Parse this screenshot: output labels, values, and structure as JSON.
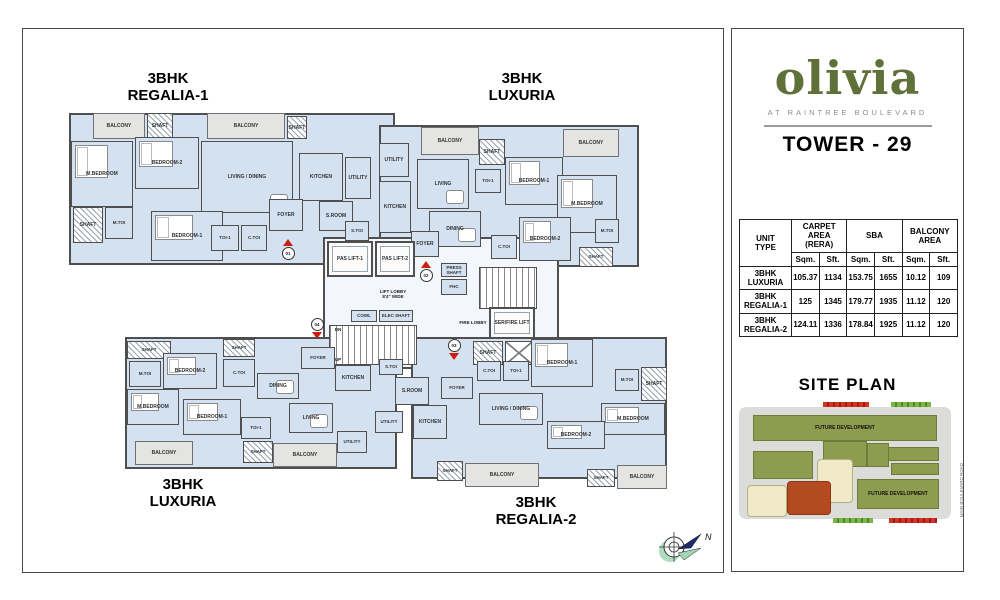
{
  "panel": {
    "logo": "olivia",
    "tagline": "AT RAINTREE BOULEVARD",
    "tower": "TOWER - 29",
    "brand_green": "#5f7038",
    "table": {
      "groups": {
        "unit": {
          "l1": "UNIT",
          "l2": "TYPE"
        },
        "carpet": {
          "l1": "CARPET AREA",
          "l2": "(RERA)"
        },
        "sba": {
          "l1": "SBA",
          "l2": ""
        },
        "balcony": {
          "l1": "BALCONY",
          "l2": "AREA"
        }
      },
      "sub_headers": [
        "Sqm.",
        "Sft.",
        "Sqm.",
        "Sft.",
        "Sqm.",
        "Sft."
      ],
      "rows": [
        {
          "type": "3BHK LUXURIA",
          "values": [
            "105.37",
            "1134",
            "153.75",
            "1655",
            "10.12",
            "109"
          ]
        },
        {
          "type": "3BHK REGALIA-1",
          "values": [
            "125",
            "1345",
            "179.77",
            "1935",
            "11.12",
            "120"
          ]
        },
        {
          "type": "3BHK REGALIA-2",
          "values": [
            "124.11",
            "1336",
            "178.84",
            "1925",
            "11.12",
            "120"
          ]
        }
      ]
    },
    "site_plan_title": "SITE PLAN",
    "site": {
      "road_label": "MAIN BOULEVARD ROAD",
      "blocks": [
        {
          "t": "green",
          "x": 14,
          "y": 18,
          "w": 184,
          "h": 26,
          "label": "FUTURE DEVELOPMENT"
        },
        {
          "t": "green",
          "x": 84,
          "y": 44,
          "w": 44,
          "h": 26
        },
        {
          "t": "green",
          "x": 14,
          "y": 54,
          "w": 60,
          "h": 28
        },
        {
          "t": "green",
          "x": 136,
          "y": 50,
          "w": 64,
          "h": 14
        },
        {
          "t": "green",
          "x": 128,
          "y": 46,
          "w": 22,
          "h": 24
        },
        {
          "t": "green",
          "x": 152,
          "y": 66,
          "w": 48,
          "h": 12
        },
        {
          "t": "green",
          "x": 118,
          "y": 82,
          "w": 82,
          "h": 30,
          "label": "FUTURE DEVELOPMENT"
        },
        {
          "t": "cream",
          "x": 8,
          "y": 88,
          "w": 40,
          "h": 32
        },
        {
          "t": "cream",
          "x": 78,
          "y": 62,
          "w": 36,
          "h": 44
        },
        {
          "t": "red",
          "x": 48,
          "y": 84,
          "w": 44,
          "h": 34
        },
        {
          "t": "mark-red",
          "x": 84,
          "y": 5,
          "w": 46,
          "h": 5
        },
        {
          "t": "mark-green",
          "x": 152,
          "y": 5,
          "w": 40,
          "h": 5
        },
        {
          "t": "mark-green",
          "x": 94,
          "y": 121,
          "w": 40,
          "h": 5
        },
        {
          "t": "mark-red",
          "x": 150,
          "y": 121,
          "w": 48,
          "h": 5
        }
      ]
    }
  },
  "compass_label": "N",
  "plan": {
    "unit_titles": [
      {
        "line1": "3BHK",
        "line2": "REGALIA-1",
        "cx": 145,
        "y": 42
      },
      {
        "line1": "3BHK",
        "line2": "LUXURIA",
        "cx": 499,
        "y": 42
      },
      {
        "line1": "3BHK",
        "line2": "LUXURIA",
        "cx": 160,
        "y": 448
      },
      {
        "line1": "3BHK",
        "line2": "REGALIA-2",
        "cx": 513,
        "y": 466
      }
    ],
    "wings": [
      {
        "x": 46,
        "y": 84,
        "w": 326,
        "h": 152,
        "core": false
      },
      {
        "x": 356,
        "y": 96,
        "w": 260,
        "h": 142,
        "core": false
      },
      {
        "x": 300,
        "y": 208,
        "w": 236,
        "h": 132,
        "core": true
      },
      {
        "x": 102,
        "y": 308,
        "w": 272,
        "h": 132,
        "core": false
      },
      {
        "x": 388,
        "y": 308,
        "w": 256,
        "h": 142,
        "core": false
      }
    ],
    "rooms": [
      {
        "n": "BALCONY",
        "x": 70,
        "y": 84,
        "w": 52,
        "h": 26,
        "t": "balcony"
      },
      {
        "n": "SHAFT",
        "x": 124,
        "y": 84,
        "w": 26,
        "h": 26,
        "t": "shaft"
      },
      {
        "n": "BALCONY",
        "x": 184,
        "y": 84,
        "w": 78,
        "h": 26,
        "t": "balcony"
      },
      {
        "n": "SHAFT",
        "x": 264,
        "y": 87,
        "w": 20,
        "h": 23,
        "t": "shaft"
      },
      {
        "n": "M.BEDROOM",
        "x": 48,
        "y": 112,
        "w": 62,
        "h": 66,
        "t": "room",
        "f": "bed"
      },
      {
        "n": "BEDROOM-2",
        "x": 112,
        "y": 108,
        "w": 64,
        "h": 52,
        "t": "room",
        "f": "bed"
      },
      {
        "n": "LIVING / DINING",
        "x": 178,
        "y": 112,
        "w": 92,
        "h": 72,
        "t": "room",
        "f": "table"
      },
      {
        "n": "KITCHEN",
        "x": 276,
        "y": 124,
        "w": 44,
        "h": 48,
        "t": "room"
      },
      {
        "n": "UTILITY",
        "x": 322,
        "y": 128,
        "w": 26,
        "h": 42,
        "t": "room"
      },
      {
        "n": "SHAFT",
        "x": 50,
        "y": 178,
        "w": 30,
        "h": 36,
        "t": "shaft"
      },
      {
        "n": "M.TOI",
        "x": 82,
        "y": 178,
        "w": 28,
        "h": 32,
        "t": "toi"
      },
      {
        "n": "BEDROOM-1",
        "x": 128,
        "y": 182,
        "w": 72,
        "h": 50,
        "t": "room",
        "f": "bed"
      },
      {
        "n": "TOI-1",
        "x": 188,
        "y": 196,
        "w": 28,
        "h": 26,
        "t": "toi"
      },
      {
        "n": "C.TOI",
        "x": 218,
        "y": 196,
        "w": 26,
        "h": 26,
        "t": "toi"
      },
      {
        "n": "FOYER",
        "x": 246,
        "y": 170,
        "w": 34,
        "h": 32,
        "t": "room"
      },
      {
        "n": "S.ROOM",
        "x": 296,
        "y": 172,
        "w": 34,
        "h": 30,
        "t": "room"
      },
      {
        "n": "S.TOI",
        "x": 322,
        "y": 192,
        "w": 24,
        "h": 20,
        "t": "toi"
      },
      {
        "n": "UTILITY",
        "x": 356,
        "y": 114,
        "w": 30,
        "h": 34,
        "t": "room"
      },
      {
        "n": "KITCHEN",
        "x": 356,
        "y": 152,
        "w": 32,
        "h": 52,
        "t": "room"
      },
      {
        "n": "BALCONY",
        "x": 398,
        "y": 98,
        "w": 58,
        "h": 28,
        "t": "balcony"
      },
      {
        "n": "LIVING",
        "x": 394,
        "y": 130,
        "w": 52,
        "h": 50,
        "t": "room",
        "f": "table"
      },
      {
        "n": "DINING",
        "x": 406,
        "y": 182,
        "w": 52,
        "h": 36,
        "t": "room",
        "f": "table"
      },
      {
        "n": "SHAFT",
        "x": 456,
        "y": 110,
        "w": 26,
        "h": 26,
        "t": "shaft"
      },
      {
        "n": "TOI-1",
        "x": 452,
        "y": 140,
        "w": 26,
        "h": 24,
        "t": "toi"
      },
      {
        "n": "BEDROOM-1",
        "x": 482,
        "y": 128,
        "w": 58,
        "h": 48,
        "t": "room",
        "f": "bed"
      },
      {
        "n": "BALCONY",
        "x": 540,
        "y": 100,
        "w": 56,
        "h": 28,
        "t": "balcony"
      },
      {
        "n": "M.BEDROOM",
        "x": 534,
        "y": 146,
        "w": 60,
        "h": 58,
        "t": "room",
        "f": "bed"
      },
      {
        "n": "BEDROOM-2",
        "x": 496,
        "y": 188,
        "w": 52,
        "h": 44,
        "t": "room",
        "f": "bed"
      },
      {
        "n": "C.TOI",
        "x": 468,
        "y": 206,
        "w": 26,
        "h": 24,
        "t": "toi"
      },
      {
        "n": "M.TOI",
        "x": 572,
        "y": 190,
        "w": 24,
        "h": 24,
        "t": "toi"
      },
      {
        "n": "SHAFT",
        "x": 556,
        "y": 218,
        "w": 34,
        "h": 20,
        "t": "shaft"
      },
      {
        "n": "FOYER",
        "x": 388,
        "y": 202,
        "w": 28,
        "h": 26,
        "t": "room"
      },
      {
        "n": "PAS LIFT-1",
        "x": 304,
        "y": 212,
        "w": 46,
        "h": 36,
        "t": "lift"
      },
      {
        "n": "PAS LIFT-2",
        "x": 352,
        "y": 212,
        "w": 40,
        "h": 36,
        "t": "lift"
      },
      {
        "n": "LIFT LOBBY\n8'4\" WIDE",
        "x": 330,
        "y": 256,
        "w": 80,
        "h": 18,
        "t": "open"
      },
      {
        "n": "COWL",
        "x": 328,
        "y": 281,
        "w": 26,
        "h": 12,
        "t": "room"
      },
      {
        "n": "ELEC SHAFT",
        "x": 356,
        "y": 281,
        "w": 34,
        "h": 12,
        "t": "room"
      },
      {
        "n": "",
        "x": 306,
        "y": 296,
        "w": 88,
        "h": 40,
        "t": "stair"
      },
      {
        "n": "DN",
        "x": 308,
        "y": 297,
        "w": 14,
        "h": 8,
        "t": "open"
      },
      {
        "n": "UP",
        "x": 308,
        "y": 327,
        "w": 14,
        "h": 8,
        "t": "open"
      },
      {
        "n": "PRESS SHAFT",
        "x": 418,
        "y": 234,
        "w": 26,
        "h": 14,
        "t": "room"
      },
      {
        "n": "FHC",
        "x": 418,
        "y": 250,
        "w": 26,
        "h": 16,
        "t": "room"
      },
      {
        "n": "",
        "x": 456,
        "y": 238,
        "w": 58,
        "h": 42,
        "t": "stair"
      },
      {
        "n": "FIRE LOBBY",
        "x": 424,
        "y": 288,
        "w": 52,
        "h": 12,
        "t": "open"
      },
      {
        "n": "SER/FIRE LIFT",
        "x": 466,
        "y": 278,
        "w": 46,
        "h": 32,
        "t": "lift"
      },
      {
        "n": "SHAFT",
        "x": 450,
        "y": 312,
        "w": 30,
        "h": 24,
        "t": "shaft"
      },
      {
        "n": "",
        "x": 482,
        "y": 312,
        "w": 28,
        "h": 24,
        "t": "xbox"
      },
      {
        "n": "SHAFT",
        "x": 104,
        "y": 312,
        "w": 44,
        "h": 18,
        "t": "shaft"
      },
      {
        "n": "M.TOI",
        "x": 106,
        "y": 332,
        "w": 32,
        "h": 26,
        "t": "toi"
      },
      {
        "n": "BEDROOM-2",
        "x": 140,
        "y": 324,
        "w": 54,
        "h": 36,
        "t": "room",
        "f": "bed"
      },
      {
        "n": "SHAFT",
        "x": 200,
        "y": 310,
        "w": 32,
        "h": 18,
        "t": "shaft"
      },
      {
        "n": "C.TOI",
        "x": 200,
        "y": 330,
        "w": 32,
        "h": 28,
        "t": "toi"
      },
      {
        "n": "FOYER",
        "x": 278,
        "y": 318,
        "w": 34,
        "h": 22,
        "t": "room"
      },
      {
        "n": "DINING",
        "x": 234,
        "y": 344,
        "w": 42,
        "h": 26,
        "t": "room",
        "f": "table"
      },
      {
        "n": "KITCHEN",
        "x": 312,
        "y": 336,
        "w": 36,
        "h": 26,
        "t": "room"
      },
      {
        "n": "S.TOI",
        "x": 356,
        "y": 330,
        "w": 24,
        "h": 16,
        "t": "toi"
      },
      {
        "n": "S.ROOM",
        "x": 372,
        "y": 348,
        "w": 34,
        "h": 28,
        "t": "room"
      },
      {
        "n": "M.BEDROOM",
        "x": 104,
        "y": 360,
        "w": 52,
        "h": 36,
        "t": "room",
        "f": "bed"
      },
      {
        "n": "BEDROOM-1",
        "x": 160,
        "y": 370,
        "w": 58,
        "h": 36,
        "t": "room",
        "f": "bed"
      },
      {
        "n": "TOI-1",
        "x": 218,
        "y": 388,
        "w": 30,
        "h": 22,
        "t": "toi"
      },
      {
        "n": "LIVING",
        "x": 266,
        "y": 374,
        "w": 44,
        "h": 30,
        "t": "room",
        "f": "table"
      },
      {
        "n": "UTILITY",
        "x": 352,
        "y": 382,
        "w": 28,
        "h": 22,
        "t": "room"
      },
      {
        "n": "UTILITY",
        "x": 314,
        "y": 402,
        "w": 30,
        "h": 22,
        "t": "room"
      },
      {
        "n": "BALCONY",
        "x": 112,
        "y": 412,
        "w": 58,
        "h": 24,
        "t": "balcony"
      },
      {
        "n": "SHAFT",
        "x": 220,
        "y": 412,
        "w": 30,
        "h": 22,
        "t": "shaft"
      },
      {
        "n": "BALCONY",
        "x": 250,
        "y": 414,
        "w": 64,
        "h": 24,
        "t": "balcony"
      },
      {
        "n": "FOYER",
        "x": 418,
        "y": 348,
        "w": 32,
        "h": 22,
        "t": "room"
      },
      {
        "n": "C.TOI",
        "x": 454,
        "y": 332,
        "w": 24,
        "h": 20,
        "t": "toi"
      },
      {
        "n": "TOI-1",
        "x": 480,
        "y": 332,
        "w": 26,
        "h": 20,
        "t": "toi"
      },
      {
        "n": "BEDROOM-1",
        "x": 508,
        "y": 310,
        "w": 62,
        "h": 48,
        "t": "room",
        "f": "bed"
      },
      {
        "n": "M.TOI",
        "x": 592,
        "y": 340,
        "w": 24,
        "h": 22,
        "t": "toi"
      },
      {
        "n": "SHAFT",
        "x": 618,
        "y": 338,
        "w": 26,
        "h": 34,
        "t": "shaft"
      },
      {
        "n": "LIVING / DINING",
        "x": 456,
        "y": 364,
        "w": 64,
        "h": 32,
        "t": "room",
        "f": "table"
      },
      {
        "n": "KITCHEN",
        "x": 390,
        "y": 376,
        "w": 34,
        "h": 34,
        "t": "room"
      },
      {
        "n": "M.BEDROOM",
        "x": 578,
        "y": 374,
        "w": 64,
        "h": 32,
        "t": "room",
        "f": "bed"
      },
      {
        "n": "BEDROOM-2",
        "x": 524,
        "y": 392,
        "w": 58,
        "h": 28,
        "t": "room",
        "f": "bed"
      },
      {
        "n": "SHAFT",
        "x": 414,
        "y": 432,
        "w": 26,
        "h": 20,
        "t": "shaft"
      },
      {
        "n": "BALCONY",
        "x": 442,
        "y": 434,
        "w": 74,
        "h": 24,
        "t": "balcony"
      },
      {
        "n": "SHAFT",
        "x": 564,
        "y": 440,
        "w": 28,
        "h": 18,
        "t": "shaft"
      },
      {
        "n": "BALCONY",
        "x": 594,
        "y": 436,
        "w": 50,
        "h": 24,
        "t": "balcony"
      }
    ],
    "markers": [
      {
        "label": "01",
        "x": 265,
        "y": 219,
        "dir": "up"
      },
      {
        "label": "02",
        "x": 403,
        "y": 241,
        "dir": "up"
      },
      {
        "label": "03",
        "x": 431,
        "y": 320,
        "dir": "down"
      },
      {
        "label": "04",
        "x": 294,
        "y": 299,
        "dir": "down"
      }
    ]
  }
}
